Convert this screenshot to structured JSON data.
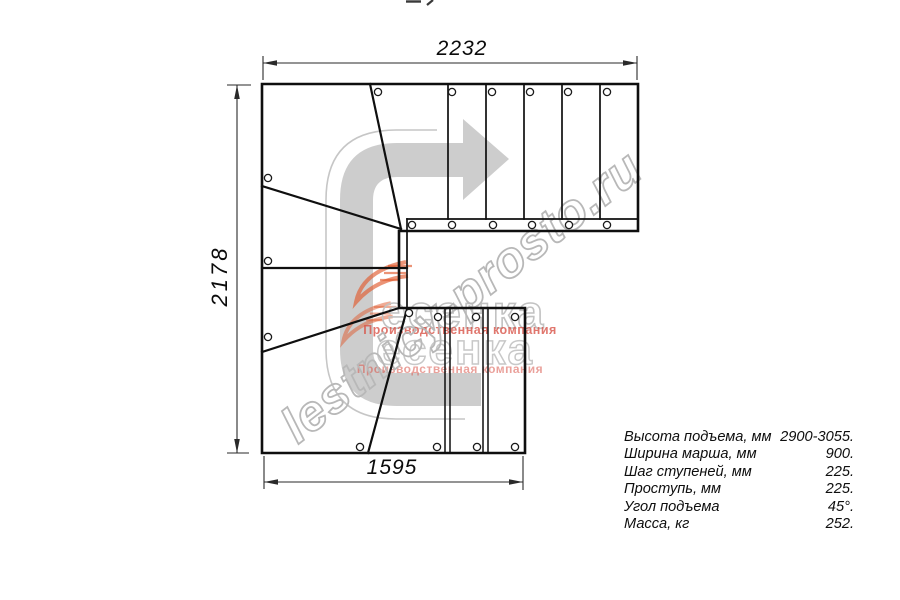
{
  "drawing": {
    "dims": {
      "top": "2232",
      "left": "2178",
      "bottom": "1595"
    },
    "specs": [
      {
        "label": "Высота подъема, мм",
        "value": "2900-3055."
      },
      {
        "label": "Ширина марша, мм",
        "value": "900."
      },
      {
        "label": "Шаг ступеней, мм",
        "value": "225."
      },
      {
        "label": "Проступь, мм",
        "value": "225."
      },
      {
        "label": "Угол подъема",
        "value": "45°."
      },
      {
        "label": "Масса, кг",
        "value": "252."
      }
    ],
    "watermark": {
      "url": "lestnicy-prosto.ru",
      "brand": "есенка",
      "tagline": "Производственная компания"
    },
    "colors": {
      "line": "#0f0f0f",
      "dimension": "#2a2a2a",
      "arrow_gray": "#cdcdcd",
      "watermark_gray": "#c0c0c0",
      "tagline_red": "#d8544a",
      "swoosh_orange": "#e05a2e"
    }
  }
}
